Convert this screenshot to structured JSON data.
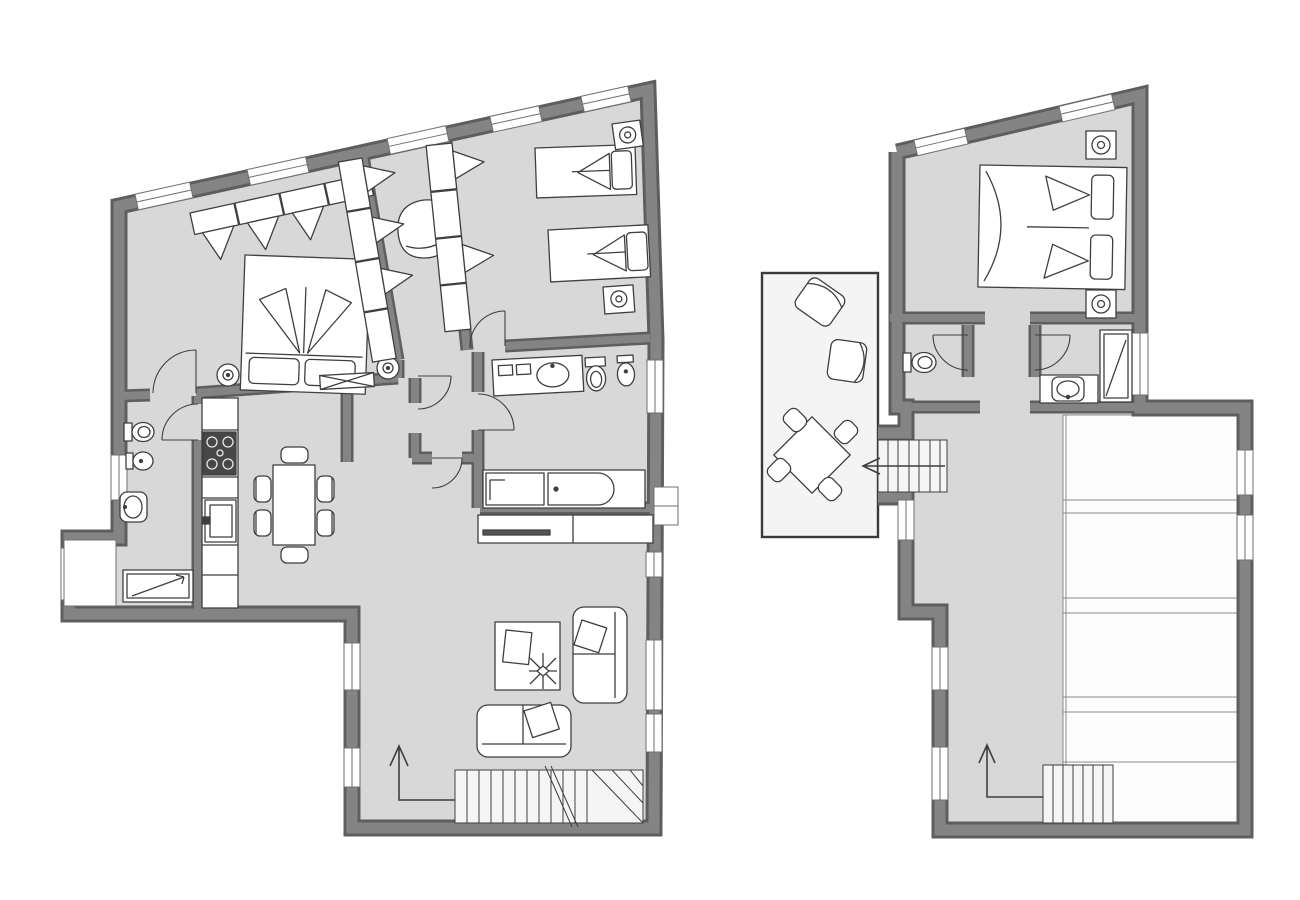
{
  "diagram": {
    "type": "floor-plan",
    "colors": {
      "background": "#ffffff",
      "wall": "#848484",
      "wall_shadow": "#5e5e5e",
      "floor": "#d8d8d8",
      "terrace": "#f4f4f4",
      "stairs": "#f5f5f5",
      "panel": "#fdfdfd",
      "panel_line": "#8a8a8a",
      "line": "#3f3f3f",
      "window_fill": "#ffffff",
      "window_frame": "#6f6f6f",
      "furniture_fill": "#ffffff",
      "hob_fill": "#474747",
      "tv_strip": "#555555"
    },
    "floors": [
      {
        "id": "ground-floor",
        "rooms": [
          "double-bedroom",
          "wardrobe-corridor",
          "twin-bedroom",
          "main-bathroom",
          "small-bathroom",
          "kitchen",
          "dining-area",
          "living-room",
          "entrance-hall",
          "window-bay"
        ],
        "furniture": [
          "wardrobe",
          "corner-armchair",
          "double-bed",
          "nightstand-lamp-left",
          "nightstand-lamp-right",
          "wardrobe-column",
          "single-bed-1",
          "single-bed-2",
          "nightstand-lamp-1",
          "nightstand-lamp-2",
          "vanity-sink",
          "toilet",
          "bidet",
          "bathtub",
          "laundry-counter",
          "tv-cabinet",
          "toilet",
          "bidet",
          "washbasin",
          "shower-tray",
          "kitchen-counter",
          "hob",
          "kitchen-sink",
          "dining-table",
          "six-chairs",
          "coffee-table",
          "decor-book",
          "decor-star",
          "sofa-right",
          "sofa-bottom",
          "staircase",
          "direction-arrow",
          "radiator"
        ],
        "window_count": 14,
        "door_count": 7,
        "staircase_count": 1
      },
      {
        "id": "upper-floor",
        "rooms": [
          "double-bedroom",
          "wc",
          "bathroom",
          "terrace",
          "landing-corridor",
          "roof-area"
        ],
        "furniture": [
          "double-bed",
          "nightstand-lamp-top",
          "nightstand-lamp-bottom",
          "toilet",
          "washbasin",
          "shower",
          "bath-counter",
          "terrace-armchair-1",
          "terrace-armchair-2",
          "outdoor-table",
          "four-chairs",
          "staircase-terrace",
          "staircase-lower",
          "direction-arrow"
        ],
        "window_count": 8,
        "door_count": 3,
        "staircase_count": 2
      }
    ]
  }
}
